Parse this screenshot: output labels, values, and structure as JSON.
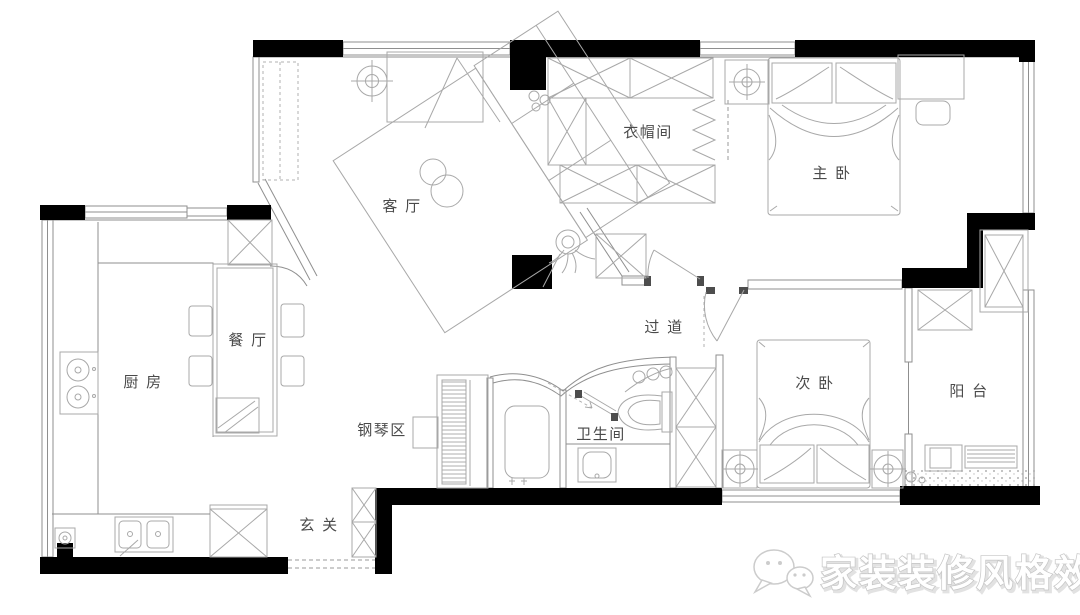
{
  "rooms": {
    "living": {
      "label": "客 厅"
    },
    "cloakroom": {
      "label": "衣帽间"
    },
    "master": {
      "label": "主 卧"
    },
    "dining": {
      "label": "餐 厅"
    },
    "kitchen": {
      "label": "厨 房"
    },
    "corridor": {
      "label": "过 道"
    },
    "piano": {
      "label": "钢琴区"
    },
    "bathroom": {
      "label": "卫生间"
    },
    "second": {
      "label": "次 卧"
    },
    "balcony": {
      "label": "阳 台"
    },
    "entry": {
      "label": "玄 关"
    }
  },
  "watermark": {
    "text": "家装装修风格效果图",
    "icon": "chat-bubbles-icon"
  },
  "colors": {
    "wall_fill": "#000000",
    "structure_line": "#8f8f8f",
    "furniture_line": "#a8a8a8",
    "label_text": "#4a4a4a",
    "watermark_outline": "#c4c4c4",
    "background": "#ffffff"
  }
}
